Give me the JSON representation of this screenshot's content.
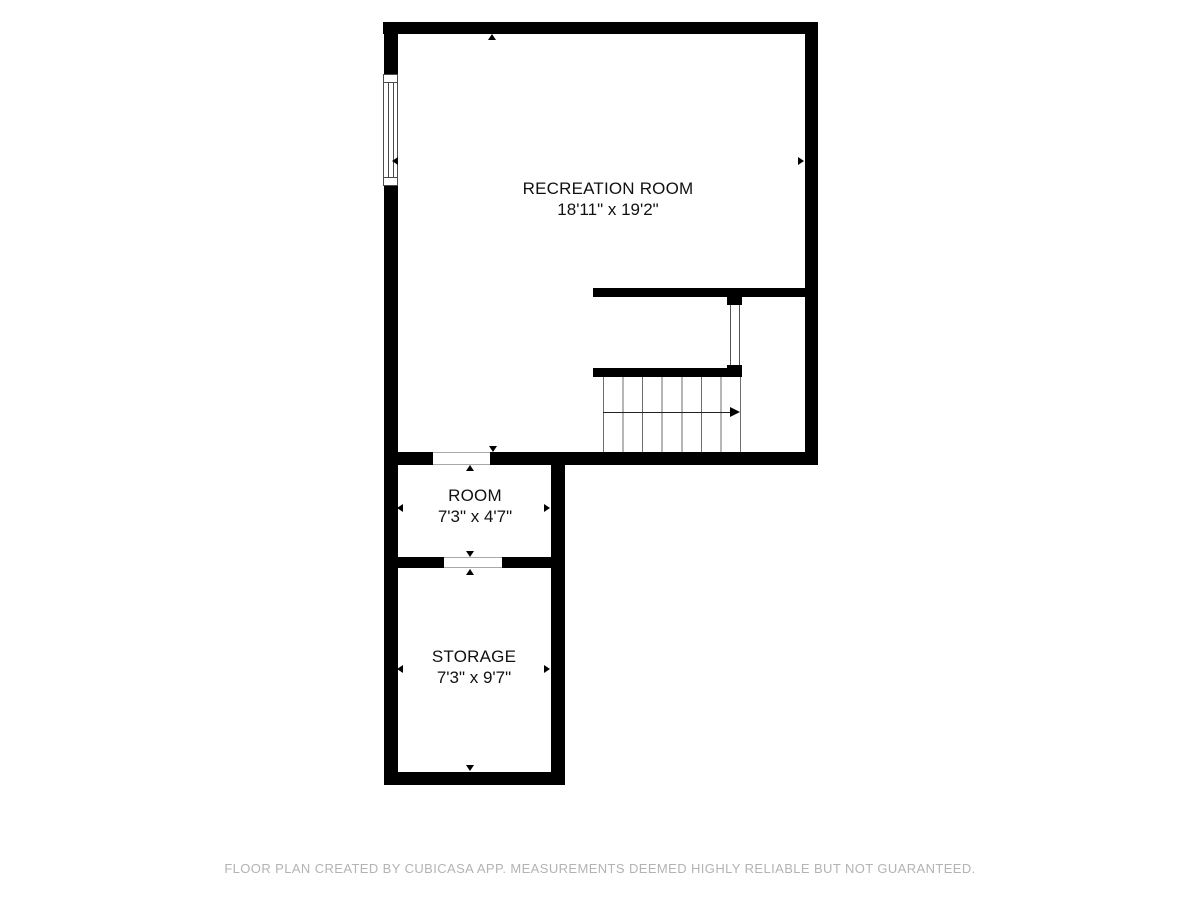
{
  "floorplan": {
    "rooms": [
      {
        "name": "RECREATION ROOM",
        "dimensions": "18'11\" x 19'2\""
      },
      {
        "name": "ROOM",
        "dimensions": "7'3\" x 4'7\""
      },
      {
        "name": "STORAGE",
        "dimensions": "7'3\" x 9'7\""
      }
    ],
    "footer": "FLOOR PLAN CREATED BY CUBICASA APP. MEASUREMENTS DEEMED HIGHLY RELIABLE BUT NOT GUARANTEED.",
    "colors": {
      "wall": "#000000",
      "thin_line": "#a9a9a9",
      "stair_tread": "#6e6e6e",
      "text": "#111111",
      "footer_text": "#b3b3b3",
      "background": "#ffffff"
    }
  }
}
